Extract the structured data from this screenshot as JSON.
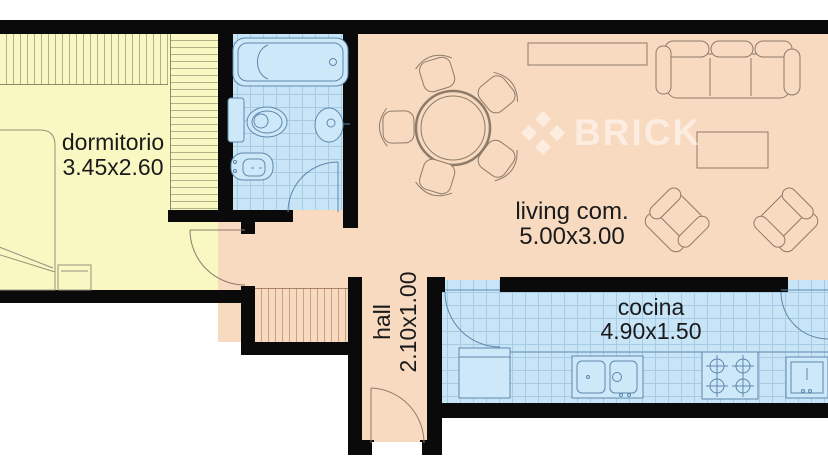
{
  "watermark": {
    "brand": "BRICK",
    "logo_icon": "brick-diamond-logo-icon"
  },
  "rooms": {
    "bedroom": {
      "label": "dormitorio",
      "size": "3.45x2.60"
    },
    "living": {
      "label": "living com.",
      "size": "5.00x3.00"
    },
    "kitchen": {
      "label": "cocina",
      "size": "4.90x1.50"
    },
    "hall": {
      "label": "hall",
      "size": "2.10x1.00"
    }
  },
  "colors": {
    "bedroom": "#F9F8C3",
    "wet_rooms": "#C8E4F7",
    "warm_floor": "#F8DAC0",
    "fixture_fill": "#CDE8F8",
    "tile_grid": "#A6CBE3",
    "walls": "#0a0a0a",
    "outline_warm": "#8D7B69",
    "outline_yellow": "#94927C",
    "outline_cool": "#5E87AC",
    "text": "#1a1a1a",
    "watermark": "rgba(255,255,255,0.5)"
  }
}
